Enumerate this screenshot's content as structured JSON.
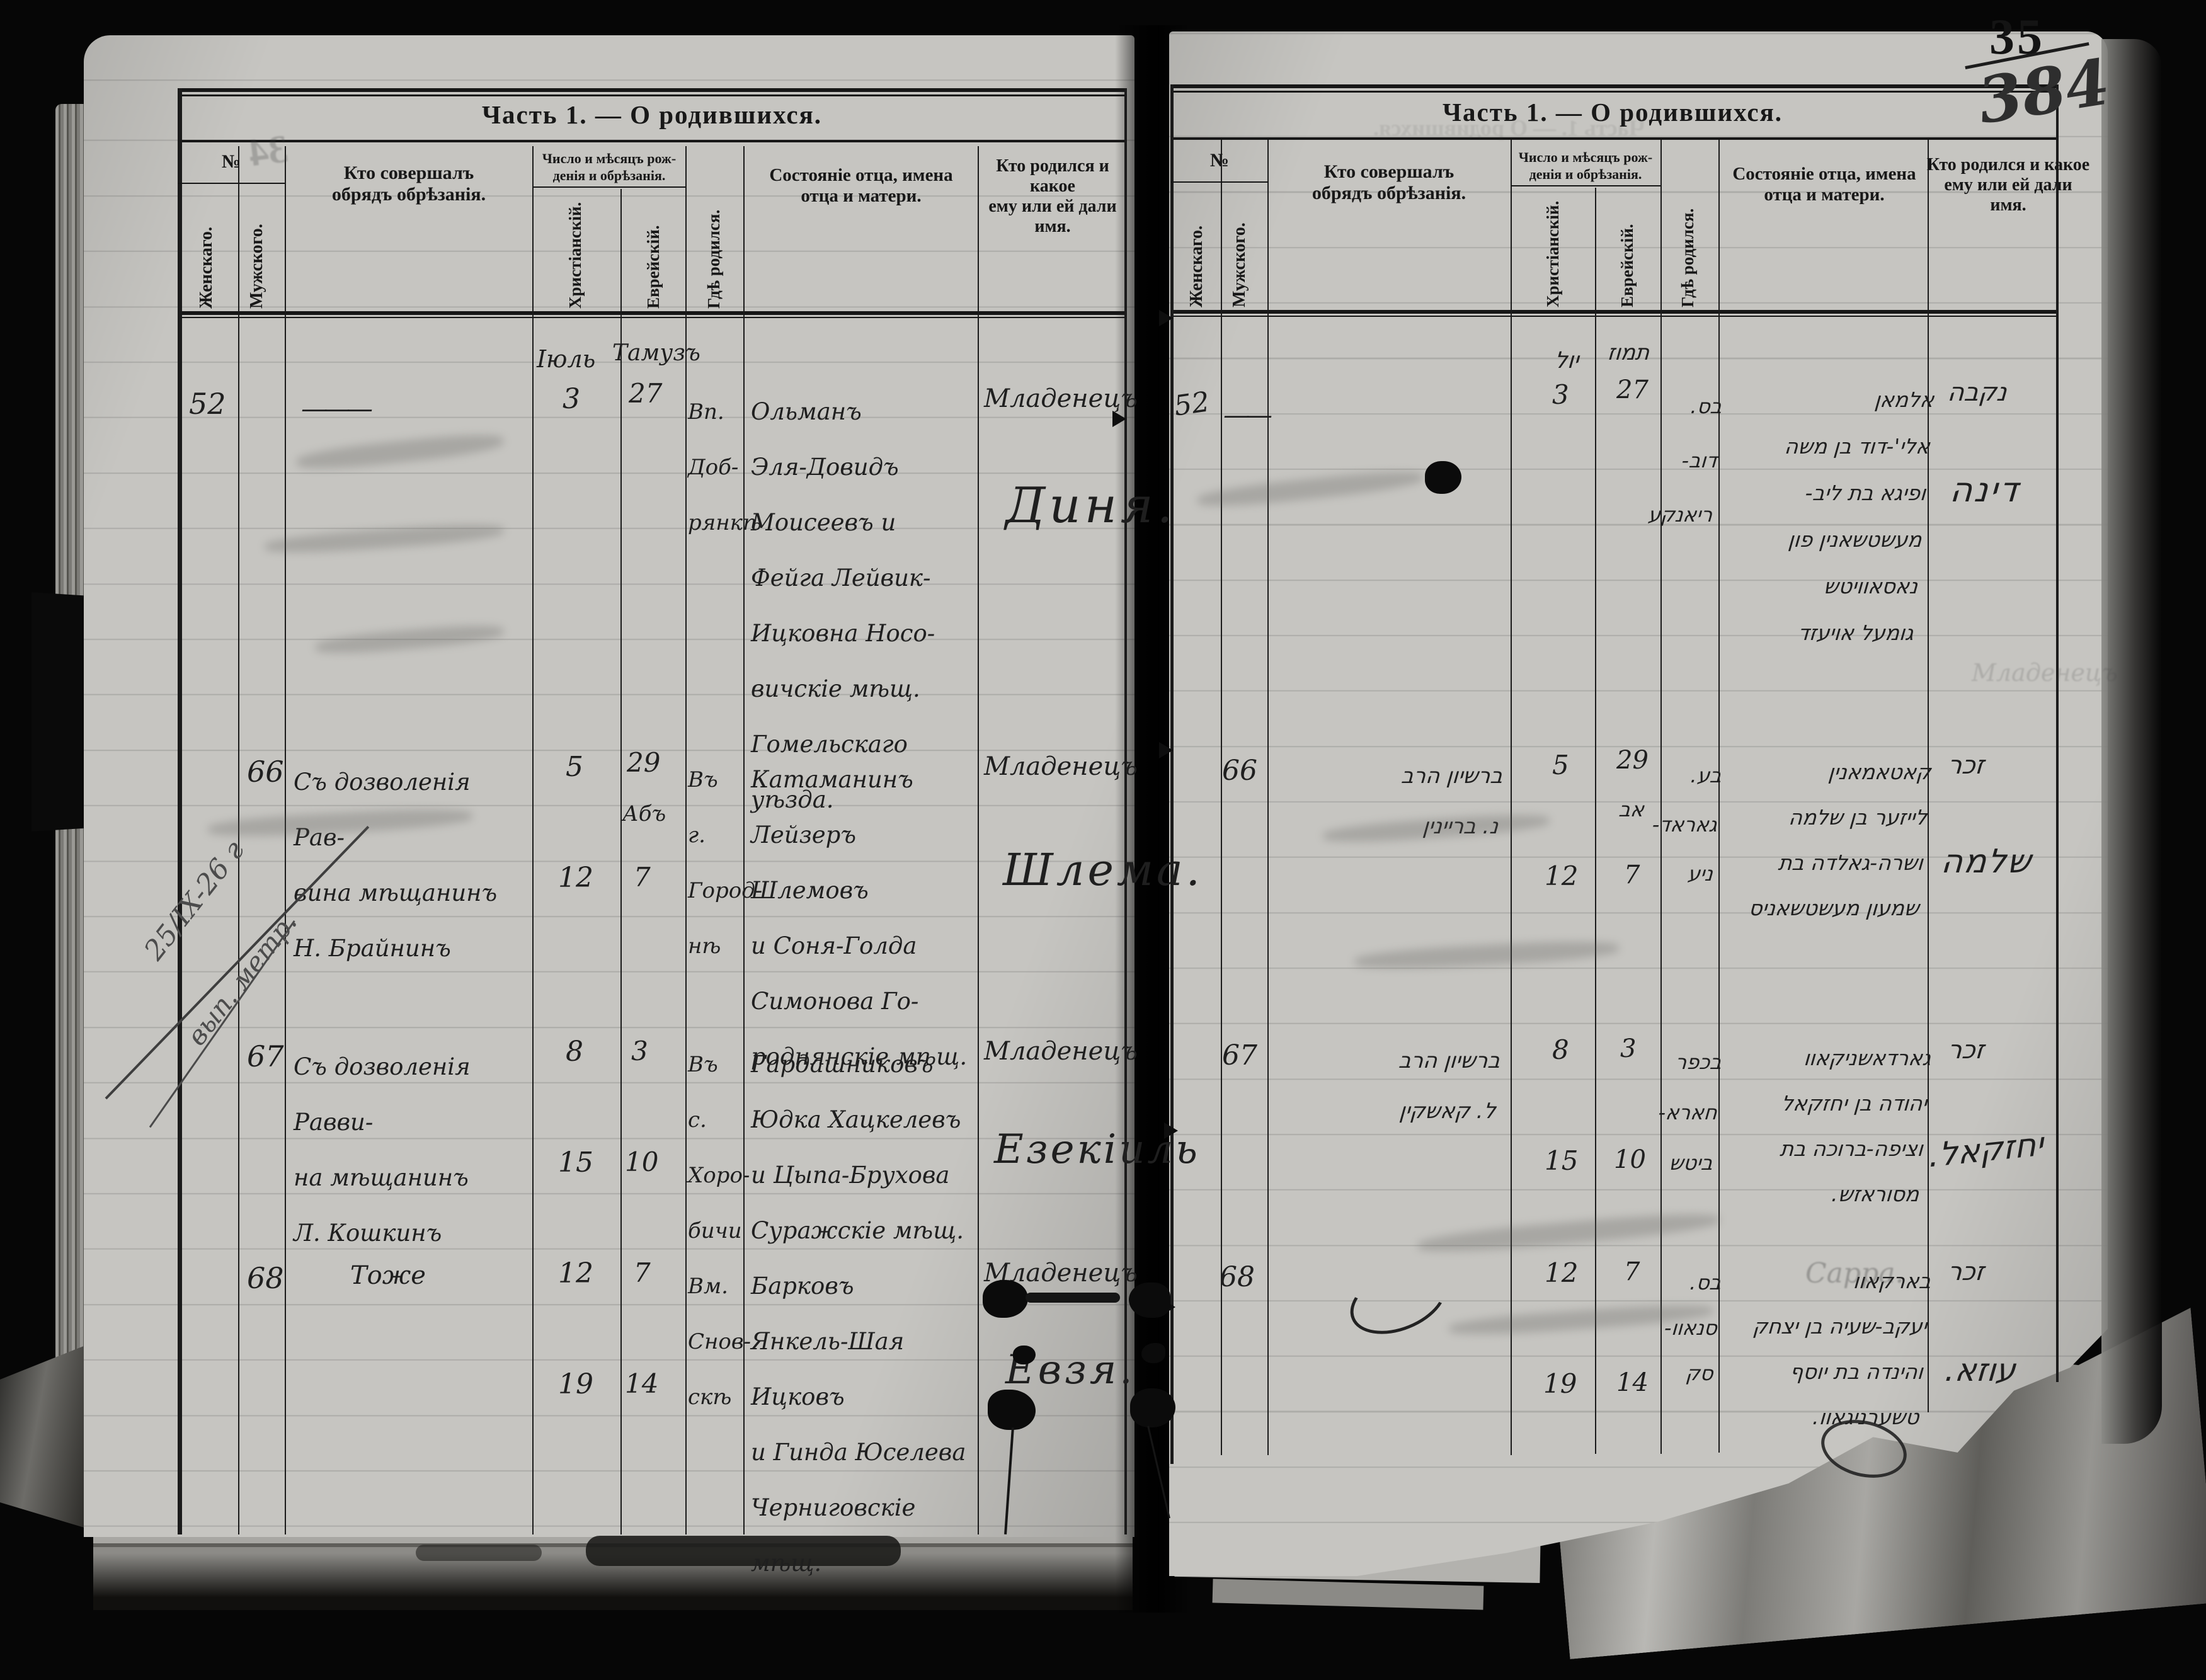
{
  "corner_marks": {
    "printed_page_number": "35",
    "handwritten_page_number": "384",
    "bleedthrough_number": "34"
  },
  "headers": {
    "title": "Часть 1. — О родившихся.",
    "no": "№",
    "female": "Женскаго.",
    "male": "Мужского.",
    "officiant": "Кто совершалъ\nобрядъ обрѣзанія.",
    "dates_group": "Число и мѣсяцъ рож-\nденія и обрѣзанія.",
    "christian": "Христіанскій.",
    "jewish": "Еврейскій.",
    "born_where": "Гдѣ родился.",
    "father": "Состояніе отца, имена\nотца и матери.",
    "child": "Кто родился и какое\nему или ей дали\nимя."
  },
  "margin_note": {
    "line1": "25/IX-26 г",
    "line2": "вып. метр."
  },
  "left_page": {
    "months": {
      "christian": "Іюль",
      "jewish": "Тамузъ"
    },
    "entries": [
      {
        "number": "52",
        "officiant": "———",
        "dates_ch": [
          "3"
        ],
        "dates_he": [
          "27"
        ],
        "place": "Вп.\nДоб-\nрянкѣ",
        "parents": "Ольманъ\nЭля-Довидъ\nМоисеевъ и\nФейга Лейвик-\nИцковна Носо-\nвичскіе мѣщ.\nГомельскаго уѣзда.",
        "child_status": "Младенецъ",
        "child_name": "Диня."
      },
      {
        "number": "66",
        "officiant": "Съ дозволенія Рав-\nвина мѣщанинъ\nН. Брайнинъ",
        "dates_ch": [
          "5",
          "12"
        ],
        "dates_he": [
          "29",
          "Абъ",
          "7"
        ],
        "place": "Въ г.\nГород-\nнѣ",
        "parents": "Катаманинъ\nЛейзеръ Шлемовъ\nи Соня-Голда\nСимонова Го-\nроднянскіе мѣщ.",
        "child_status": "Младенецъ",
        "child_name": "Шлема."
      },
      {
        "number": "67",
        "officiant": "Съ дозволенія Равви-\nна мѣщанинъ\nЛ. Кошкинъ",
        "dates_ch": [
          "8",
          "15"
        ],
        "dates_he": [
          "3",
          "10"
        ],
        "place": "Въ с.\nХоро-\nбичи",
        "parents": "Гардашниковъ\nЮдка Хацкелевъ\nи Цыпа-Брухова\nСуражскіе мѣщ.",
        "child_status": "Младенецъ",
        "child_name": "Езекіиль"
      },
      {
        "number": "68",
        "officiant": "Тоже",
        "dates_ch": [
          "12",
          "19"
        ],
        "dates_he": [
          "7",
          "14"
        ],
        "place": "Вм.\nСнов-\nскѣ",
        "parents": "Барковъ\nЯнкель-Шая Ицковъ\nи Гинда Юселева\nЧерниговскіе мѣщ.",
        "child_status": "Младенецъ",
        "child_name": "Евзя."
      }
    ]
  },
  "right_page": {
    "months": {
      "christian": "יול",
      "jewish": "תמוז"
    },
    "entries": [
      {
        "number": "52",
        "officiant": "——",
        "dates_ch": [
          "3"
        ],
        "dates_he": [
          "27"
        ],
        "place": "בס.\nדוב-\nריאנקע",
        "parents": "אלמאן\nאלי'-דוד בן משה\nופיגא בת ליב-\nמעשטשאנין פון\nנאסאוויטש\nגומעל אויעזד",
        "child_status": "נקבה",
        "child_name": "דינה"
      },
      {
        "number": "66",
        "officiant": "ברשיון הרב\nנ. בריינין",
        "dates_ch": [
          "5",
          "12"
        ],
        "dates_he": [
          "29",
          "אב",
          "7"
        ],
        "place": "בע.\nגאראד-\nניע",
        "parents": "קאטאמאנין\nלייזער בן שלמה\nושרה-גאלדה בת\nשמעון מעשטשאניס",
        "child_status": "זכר",
        "child_name": "שלמה"
      },
      {
        "number": "67",
        "officiant": "ברשיון הרב\nל. קאשקין",
        "dates_ch": [
          "8",
          "15"
        ],
        "dates_he": [
          "3",
          "10"
        ],
        "place": "בכפר\nחארא-\nביטש",
        "parents": "גארדאשניקאוו\nיהודה בן יחזקאל\nוציפה-ברוכה בת\nמסוראזש.",
        "child_status": "זכר",
        "child_name": "יחזקאל."
      },
      {
        "number": "68",
        "officiant": "",
        "dates_ch": [
          "12",
          "19"
        ],
        "dates_he": [
          "7",
          "14"
        ],
        "place": "בס.\nסנאוו-\nסק",
        "parents": "בארקאוו\nיעקב-שעיה בן יצחק\nוהינדה בת יוסף\nטשערניגאוו.",
        "child_status": "זכר",
        "child_name": "עוזא."
      }
    ]
  },
  "bleedthrough": {
    "sarra": "Сарра.",
    "mladenets": "Младенецъ",
    "title_ghost": "Часть 1. — О родившихся."
  }
}
